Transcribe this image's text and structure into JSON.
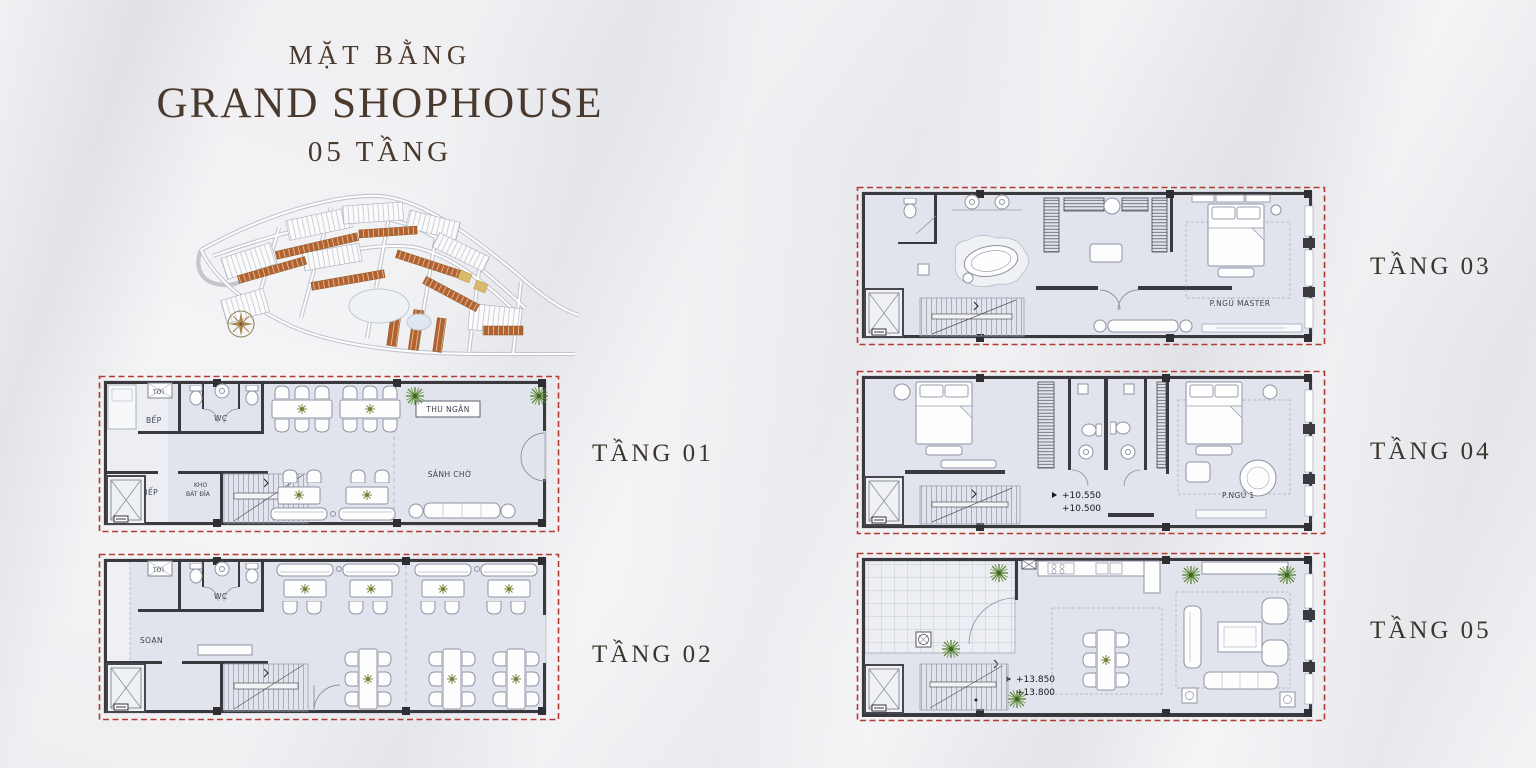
{
  "header": {
    "line1": "MẶT BẰNG",
    "line2": "GRAND SHOPHOUSE",
    "line3": "05 TẦNG",
    "text_color": "#4a392d"
  },
  "colors": {
    "boundary_red": "#b23a31",
    "masterplan_brown": "#b4622d",
    "plan_fill": "#e2e4ed",
    "wall": "#39393e",
    "plant_green": "#4e7a2c",
    "compass_gold": "#a9854e"
  },
  "floors": [
    {
      "label": "TẦNG 01",
      "rooms": {
        "toi": "TỜI",
        "bep": "BẾP",
        "wc": "WC",
        "kho_bep": "KHO BẾP",
        "kho_bat_dia_1": "KHO",
        "kho_bat_dia_2": "BÁT ĐĨA",
        "thu_ngan": "THU NGÂN",
        "sanh_cho": "SẢNH CHỜ"
      }
    },
    {
      "label": "TẦNG 02",
      "rooms": {
        "toi": "TỜI",
        "wc": "WC",
        "soan": "SOẠN"
      }
    },
    {
      "label": "TẦNG 03",
      "rooms": {
        "p_ngu_master": "P.NGỦ MASTER"
      }
    },
    {
      "label": "TẦNG 04",
      "rooms": {
        "p_ngu_1": "P.NGỦ 1",
        "level_a": "+10.550",
        "level_b": "+10.500"
      }
    },
    {
      "label": "TẦNG 05",
      "rooms": {
        "level_a": "+13.850",
        "level_b": "+13.800"
      }
    }
  ]
}
